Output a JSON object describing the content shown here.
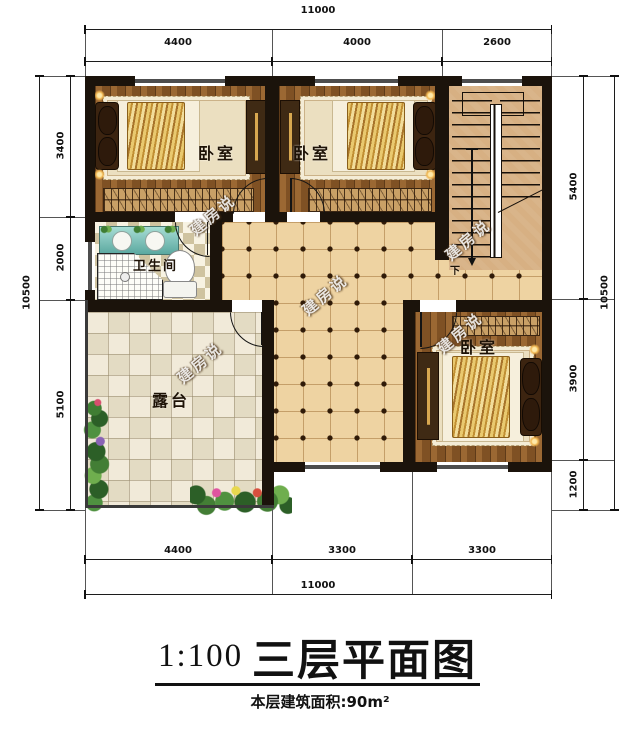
{
  "title_block": {
    "scale": "1:100",
    "title": "三层平面图",
    "area_note": "本层建筑面积:90m²"
  },
  "rooms": {
    "bedroom1": "卧室",
    "bedroom2": "卧室",
    "bedroom3": "卧室",
    "bathroom": "卫生间",
    "terrace": "露台"
  },
  "stairs": {
    "down_label": "下"
  },
  "watermark": {
    "text": "建房说"
  },
  "dimensions": {
    "top": {
      "overall": "11000",
      "segments": [
        "4400",
        "4000",
        "2600"
      ]
    },
    "bottom": {
      "overall": "11000",
      "segments": [
        "4400",
        "3300",
        "3300"
      ]
    },
    "left": {
      "overall": "10500",
      "segments": [
        "3400",
        "2000",
        "5100"
      ]
    },
    "right": {
      "overall": "10500",
      "segments": [
        "5400",
        "3900",
        "1200"
      ]
    }
  },
  "colors": {
    "wall": "#1b130b",
    "wood_floor": "#8d5a28",
    "hall_tile": "#eed3a2",
    "stair_floor": "#d7b083",
    "terrace_tile": "#f1ead9",
    "blanket_gold": "#d9a840",
    "vanity_teal": "#5ba8a0"
  }
}
